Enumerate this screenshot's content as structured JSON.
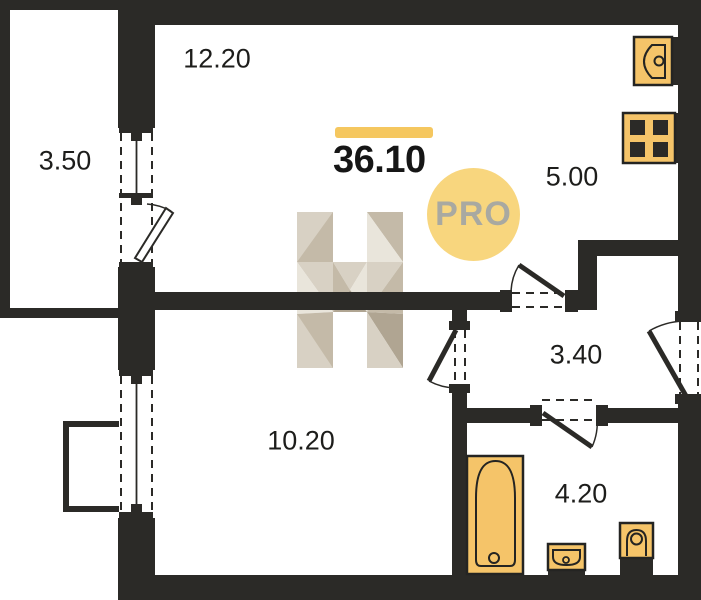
{
  "plan": {
    "total_area_value": "36.10",
    "pro_badge_label": "PRO",
    "rooms": [
      {
        "name": "living-kitchen",
        "area": "12.20"
      },
      {
        "name": "balcony",
        "area": "3.50"
      },
      {
        "name": "kitchen-zone",
        "area": "5.00"
      },
      {
        "name": "hallway",
        "area": "3.40"
      },
      {
        "name": "bedroom",
        "area": "10.20"
      },
      {
        "name": "bathroom",
        "area": "4.20"
      }
    ],
    "fixtures": [
      "kitchen-sink",
      "stove",
      "bathtub",
      "washbasin",
      "toilet"
    ],
    "colors": {
      "walls": "#2b2a27",
      "fixture_fill": "#f5c469",
      "accent_bar": "#f5c75f",
      "pro_badge_bg": "#f8d67e",
      "pro_badge_text": "#a9a9a1",
      "watermark_palette": [
        "#e9e5db",
        "#d8d1c4",
        "#c4baa8",
        "#b0a592"
      ]
    }
  }
}
